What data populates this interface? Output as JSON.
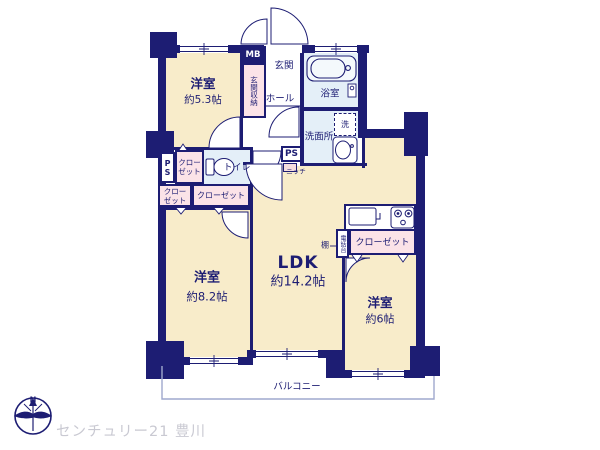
{
  "plan": {
    "rooms": {
      "bedroom1": {
        "name": "洋室",
        "size": "約5.3帖"
      },
      "bedroom2": {
        "name": "洋室",
        "size": "約8.2帖"
      },
      "bedroom3": {
        "name": "洋室",
        "size": "約6帖"
      },
      "ldk": {
        "name": "LDK",
        "size": "約14.2帖"
      },
      "entrance": "玄関",
      "hall": "ホール",
      "bathroom": "浴室",
      "washroom": "洗面所",
      "toilet": "トイレ",
      "balcony": "バルコニー"
    },
    "fixtures": {
      "mb": "MB",
      "entrance_storage": "玄関収納",
      "ps_left": "PS",
      "ps_right": "PS",
      "niche": "ニッチ",
      "washer": "洗",
      "shelf": "棚",
      "phone_stand": "電話台",
      "closet_a_line1": "クロー",
      "closet_a_line2": "ゼット",
      "closet_b_line1": "クロー",
      "closet_b_line2": "ゼット",
      "closet_wide": "クローゼット",
      "closet_right": "クローゼット"
    },
    "compass": {
      "north": "N"
    },
    "watermark": "センチュリー21 豊川",
    "colors": {
      "wall": "#1d1d73",
      "room_floor": "#f8ecca",
      "closet_fill": "#fbe3e8",
      "wet_area_fill": "#e4eff8",
      "balcony_line": "#9fa9ce",
      "watermark_text": "#c9c9d2"
    }
  }
}
